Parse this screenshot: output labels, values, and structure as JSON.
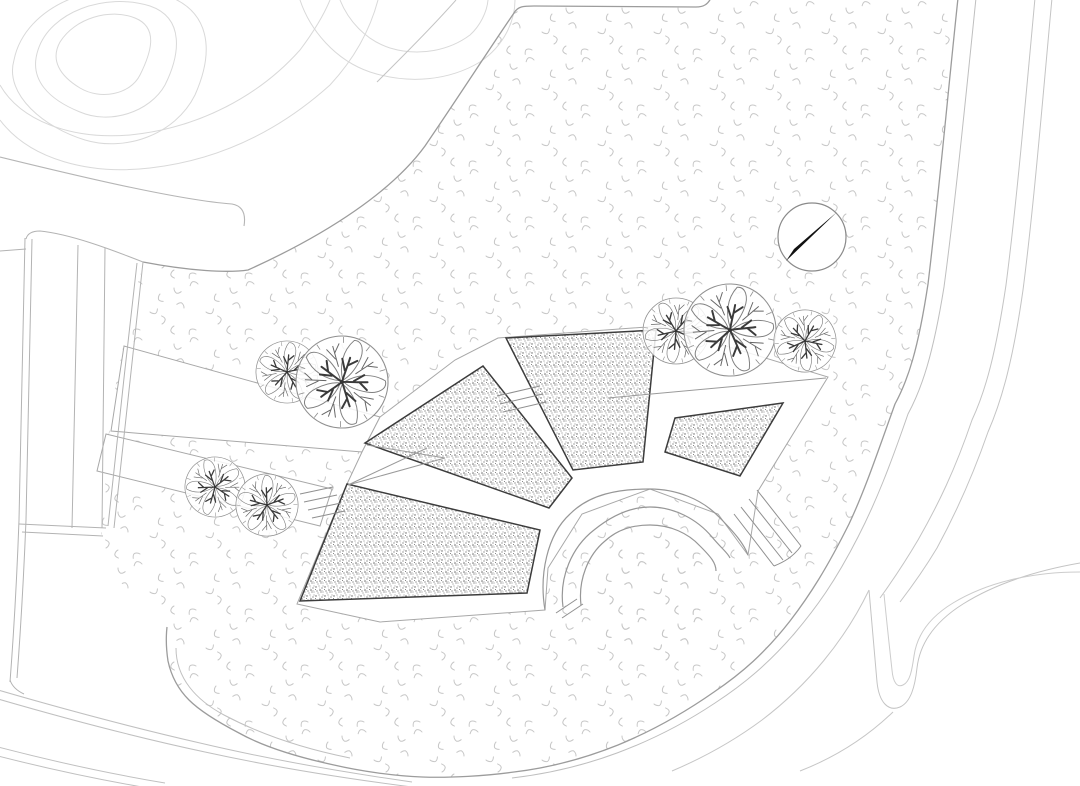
{
  "site": {
    "width": 1080,
    "height": 786,
    "kind": "landscape-site-plan"
  },
  "palette": {
    "background": "#ffffff",
    "grass_mark": "#c7c7c7",
    "stipple_dot": "#606060",
    "bed_border": "#3c3c3c",
    "edge_line": "#a8a8a8",
    "boundary_line": "#9c9c9c",
    "road_line": "#c0c0c0",
    "contour_line": "#d9d9d9",
    "arc_line": "#979797",
    "tree_branch": "#3a3a3a",
    "tree_outline": "#909090",
    "needle": "#111111"
  },
  "north_arrow": {
    "cx": 812,
    "cy": 237,
    "r": 34,
    "needle_points": "837,212 786,261 794,249"
  },
  "trees": [
    {
      "cx": 287,
      "cy": 372,
      "r": 31,
      "rot": 10
    },
    {
      "cx": 342,
      "cy": 382,
      "r": 46,
      "rot": 95
    },
    {
      "cx": 215,
      "cy": 487,
      "r": 30,
      "rot": 200
    },
    {
      "cx": 267,
      "cy": 505,
      "r": 31,
      "rot": 290
    },
    {
      "cx": 676,
      "cy": 331,
      "r": 33,
      "rot": 45
    },
    {
      "cx": 730,
      "cy": 330,
      "r": 46,
      "rot": 160
    },
    {
      "cx": 805,
      "cy": 341,
      "r": 31,
      "rot": 250
    }
  ],
  "tree_parts": {
    "petal": "M0,-2 C-9,-14 -12,-30 -5,-44 C3,-47 9,-38 8,-26 C7,-15 4,-7 0,-2 Z",
    "branch": "M0,0 C-1,-8 -1,-16 -2,-26 M-2,-12 L-9,-22 M-1,-18 L6,-26",
    "twig": "M0,-16 L-1,-38 M-1,-24 L-8,-36 M-1,-30 L6,-39",
    "tick": "M0,-40 L0,-46"
  },
  "ops": [
    {
      "t": "path",
      "name": "grass-lawn-area",
      "d": "M143,262 C190,271 228,273 248,270 C330,233 393,190 425,146 C457,99 492,45 514,13 C518,6 524,6 534,6 L696,7 C704,7 708,4 711,-2 L958,-2 C948,92 938,202 928,284 C918,350 908,380 895,404 C877,454 865,490 849,524 C827,568 810,595 790,621 C765,653 742,673 714,692 C684,713 652,731 618,745 C583,759 548,768 514,772 C486,776 450,778 422,777 C394,776 360,771 334,765 C297,757 264,747 239,733 C216,721 199,710 189,700 C177,688 171,675 168,661 C166,648 166,636 167,627 C145,612 118,585 105,555 C99,536 100,498 103,468 C106,444 108,436 110,428 C116,370 129,320 143,262 Z",
      "f": "url(#grass)",
      "s": "none",
      "w": 0
    },
    {
      "t": "circle",
      "name": "amphitheater-lawn-bowl",
      "cx": 650,
      "cy": 597,
      "r": 66,
      "f": "url(#grass)",
      "s": "none",
      "w": 0
    },
    {
      "t": "path",
      "name": "contour-line",
      "d": "M60,42 C75,18 110,8 135,18 C160,28 150,55 140,75 C130,95 100,100 80,88 C60,76 50,60 60,42 Z",
      "f": "none",
      "s": "#d9d9d9",
      "w": 1
    },
    {
      "t": "path",
      "name": "contour-line",
      "d": "M38,50 C50,12 105,-8 150,6 C185,18 180,55 165,85 C150,112 110,125 80,112 C50,100 28,80 38,50 Z",
      "f": "none",
      "s": "#d9d9d9",
      "w": 1
    },
    {
      "t": "path",
      "name": "contour-line",
      "d": "M14,60 C25,5 100,-25 165,-5 C210,10 215,50 195,95 C175,135 125,152 85,140 C45,128 4,95 14,60 Z",
      "f": "none",
      "s": "#d9d9d9",
      "w": 1
    },
    {
      "t": "path",
      "name": "contour-line",
      "d": "M0,85 C20,120 70,140 130,135 C200,128 260,95 300,50 C315,30 325,12 330,0",
      "f": "none",
      "s": "#d9d9d9",
      "w": 1
    },
    {
      "t": "path",
      "name": "contour-line",
      "d": "M0,120 C30,160 90,175 150,168 C220,160 280,130 330,85 C355,58 370,30 378,0",
      "f": "none",
      "s": "#d9d9d9",
      "w": 1
    },
    {
      "t": "path",
      "name": "contour-line",
      "d": "M300,0 C310,30 335,60 370,72 C410,85 450,80 480,62 C505,45 515,20 515,0",
      "f": "none",
      "s": "#d9d9d9",
      "w": 1
    },
    {
      "t": "path",
      "name": "contour-line",
      "d": "M340,0 C348,20 365,40 390,48 C420,57 450,50 470,35 C480,26 487,12 488,0",
      "f": "none",
      "s": "#d9d9d9",
      "w": 1
    },
    {
      "t": "path",
      "name": "upper-path-edge",
      "d": "M0,157 C90,179 180,200 232,204 C243,206 246,214 244,226",
      "f": "none",
      "s": "#b5b5b5",
      "w": 1.1
    },
    {
      "t": "path",
      "name": "diagonal-path-edge",
      "d": "M377,82 C404,55 432,27 456,0",
      "f": "none",
      "s": "#c4c4c4",
      "w": 1
    },
    {
      "t": "path",
      "name": "lawn-top-boundary",
      "d": "M143,262 C190,271 228,273 248,270 C330,233 393,190 425,146 C457,99 492,45 514,13 C518,6 524,6 534,6 L696,7 C704,7 708,4 711,-2",
      "f": "none",
      "s": "#9c9c9c",
      "w": 1.3
    },
    {
      "t": "poly",
      "name": "walkway-upper",
      "pts": "124,346 380,417 362,452 111,431",
      "f": "#ffffff",
      "s": "#a8a8a8",
      "w": 1
    },
    {
      "t": "poly",
      "name": "walkway-lower",
      "pts": "106,434 332,489 320,526 97,471",
      "f": "#ffffff",
      "s": "#a8a8a8",
      "w": 1
    },
    {
      "t": "poly",
      "name": "fan-plaza",
      "pts": "380,417 455,360 498,338 660,326 828,377 758,491 748,555 718,514 650,489 582,514 548,568 545,610 380,622 297,604 347,484 362,452",
      "f": "#ffffff",
      "s": "#a8a8a8",
      "w": 1
    },
    {
      "t": "poly",
      "name": "planting-bed-1",
      "pts": "300,601 347,484 540,530 527,593",
      "f": "url(#stipple)",
      "s": "#3c3c3c",
      "w": 1.5
    },
    {
      "t": "poly",
      "name": "planting-bed-2",
      "pts": "365,443 483,366 572,478 549,508",
      "f": "url(#stipple)",
      "s": "#3c3c3c",
      "w": 1.5
    },
    {
      "t": "poly",
      "name": "planting-bed-3",
      "pts": "506,338 656,330 643,462 573,470",
      "f": "url(#stipple)",
      "s": "#3c3c3c",
      "w": 1.5
    },
    {
      "t": "poly",
      "name": "planting-bed-4",
      "pts": "675,418 783,403 740,476 665,452",
      "f": "url(#stipple)",
      "s": "#3c3c3c",
      "w": 1.5
    },
    {
      "t": "path",
      "name": "amphitheater-arc-inner",
      "d": "M581,605 C578,580 588,555 605,541 C618,529 633,525 650,525 C670,525 688,533 700,546 C711,557 716,563 716,571",
      "f": "none",
      "s": "#979797",
      "w": 1.2
    },
    {
      "t": "path",
      "name": "amphitheater-arc-middle",
      "d": "M563,607 C559,577 572,547 594,530 C610,517 629,507 650,507 C674,507 697,519 712,537 C722,549 728,553 730,558",
      "f": "none",
      "s": "#979797",
      "w": 1.2
    },
    {
      "t": "path",
      "name": "amphitheater-arc-outer",
      "d": "M545,610 C539,575 547,535 570,514 C590,494 618,489 650,489 C676,489 702,499 719,517 C735,533 744,544 748,555",
      "f": "none",
      "s": "#979797",
      "w": 1.2
    },
    {
      "t": "lines",
      "name": "amphitheater-stairs",
      "s": "#8f8f8f",
      "w": 1,
      "segs": [
        [
          757,
          490,
          801,
          546
        ],
        [
          749,
          499,
          792,
          553
        ],
        [
          741,
          507,
          783,
          560
        ],
        [
          734,
          514,
          774,
          566
        ]
      ]
    },
    {
      "t": "path",
      "name": "stair-edge",
      "d": "M801,546 C793,557 784,562 774,566",
      "f": "none",
      "s": "#8f8f8f",
      "w": 1
    },
    {
      "t": "lines",
      "name": "steps-between-beds",
      "s": "#8f8f8f",
      "w": 1,
      "segs": [
        [
          497,
          396,
          540,
          386
        ],
        [
          500,
          404,
          543,
          394
        ],
        [
          503,
          412,
          546,
          402
        ]
      ]
    },
    {
      "t": "lines",
      "name": "steps-walkway",
      "s": "#8f8f8f",
      "w": 1,
      "segs": [
        [
          300,
          494,
          333,
          487
        ],
        [
          304,
          502,
          337,
          495
        ],
        [
          308,
          510,
          341,
          503
        ],
        [
          312,
          518,
          345,
          511
        ]
      ]
    },
    {
      "t": "lines",
      "name": "ramp-zigzag",
      "s": "#9a9a9a",
      "w": 1,
      "segs": [
        [
          348,
          485,
          445,
          458
        ],
        [
          367,
          445,
          445,
          458
        ],
        [
          348,
          485,
          427,
          448
        ]
      ]
    },
    {
      "t": "lines",
      "name": "path-end-cap",
      "s": "#8f8f8f",
      "w": 1,
      "segs": [
        [
          556,
          613,
          577,
          599
        ],
        [
          562,
          618,
          583,
          604
        ]
      ]
    },
    {
      "t": "path",
      "name": "plaza-top-edge",
      "d": "M608,398 L826,378",
      "f": "none",
      "s": "#9a9a9a",
      "w": 1
    },
    {
      "t": "path",
      "name": "lawn-right-boundary",
      "d": "M958,-2 C948,92 938,202 928,284 C918,350 908,380 895,404 C877,454 865,490 849,524 C827,568 810,595 790,621 C765,653 742,673 714,692 C684,713 652,731 618,745 C583,759 548,768 514,772 C486,776 450,778 422,777 C394,776 360,771 334,765 C297,757 264,747 239,733 C216,721 199,710 189,700 C177,688 171,675 168,661 C166,648 166,636 167,627",
      "f": "none",
      "s": "#9c9c9c",
      "w": 1.3
    },
    {
      "t": "path",
      "name": "lawn-corner-inner-line",
      "d": "M176,648 C176,678 196,700 224,715 C258,733 300,748 350,758",
      "f": "none",
      "s": "#c0c0c0",
      "w": 1
    },
    {
      "t": "path",
      "name": "ring-road-line",
      "d": "M976,-2 C966,95 955,205 944,287 C933,355 922,388 908,414 C890,466 876,502 858,537 C835,582 816,608 794,634 C768,664 744,684 715,703 C685,723 652,740 617,753 C582,766 546,774 512,778",
      "f": "none",
      "s": "#bfbfbf",
      "w": 1
    },
    {
      "t": "path",
      "name": "ring-road-line",
      "d": "M1035,-2 C1026,95 1017,200 1006,285 C996,352 986,390 972,420 C955,470 938,505 918,540 C905,562 893,580 880,598",
      "f": "none",
      "s": "#c4c4c4",
      "w": 1
    },
    {
      "t": "path",
      "name": "ring-road-line",
      "d": "M1052,-2 C1043,95 1034,205 1023,290 C1013,360 1002,400 988,432 C972,478 956,513 937,548 C925,568 913,585 900,602",
      "f": "none",
      "s": "#c4c4c4",
      "w": 1
    },
    {
      "t": "path",
      "name": "hairpin-path",
      "d": "M869,590 C872,625 875,660 877,682 C879,702 888,712 900,707 C911,702 915,686 917,668 C920,642 936,621 963,604 C998,582 1040,570 1080,563",
      "f": "none",
      "s": "#c4c4c4",
      "w": 1
    },
    {
      "t": "path",
      "name": "hairpin-path",
      "d": "M884,594 C887,625 890,652 892,670 C893,682 897,688 903,685 C910,682 912,670 914,656 C917,634 930,617 953,603 C986,583 1030,572 1080,572",
      "f": "none",
      "s": "#cccccc",
      "w": 1
    },
    {
      "t": "path",
      "name": "south-path-line",
      "d": "M869,590 C845,640 808,685 762,720 C735,740 705,757 672,771",
      "f": "none",
      "s": "#c6c6c6",
      "w": 1
    },
    {
      "t": "path",
      "name": "south-path-line",
      "d": "M893,712 C867,737 836,757 800,771",
      "f": "none",
      "s": "#c6c6c6",
      "w": 1
    },
    {
      "t": "path",
      "name": "southwest-road-line",
      "d": "M-2,690 C60,708 130,727 200,743 C272,760 342,772 412,782",
      "f": "none",
      "s": "#c0c0c0",
      "w": 1
    },
    {
      "t": "path",
      "name": "southwest-road-line",
      "d": "M-2,699 C60,717 130,736 205,752 C278,768 348,779 420,788",
      "f": "none",
      "s": "#c0c0c0",
      "w": 1
    },
    {
      "t": "path",
      "name": "southwest-road-line",
      "d": "M-2,747 C48,760 105,773 165,783",
      "f": "none",
      "s": "#c0c0c0",
      "w": 1
    },
    {
      "t": "path",
      "name": "southwest-road-line",
      "d": "M-2,756 C45,768 95,779 148,788",
      "f": "none",
      "s": "#c0c0c0",
      "w": 1
    },
    {
      "t": "path",
      "name": "west-road-line",
      "d": "M25,238 C23,330 21,430 19,520 C17,575 14,630 10,682",
      "f": "none",
      "s": "#b3b3b3",
      "w": 1
    },
    {
      "t": "path",
      "name": "west-road-line",
      "d": "M32,239 C30,330 28,430 26,520 C24,570 21,625 17,678",
      "f": "none",
      "s": "#b3b3b3",
      "w": 1
    },
    {
      "t": "path",
      "name": "west-road-line",
      "d": "M78,245 C76,340 74,440 72,528",
      "f": "none",
      "s": "#b3b3b3",
      "w": 1
    },
    {
      "t": "path",
      "name": "west-road-line",
      "d": "M105,248 C104,340 103,440 102,528",
      "f": "none",
      "s": "#b3b3b3",
      "w": 1
    },
    {
      "t": "path",
      "name": "west-road-line",
      "d": "M137,263 C127,350 117,440 108,526",
      "f": "none",
      "s": "#b3b3b3",
      "w": 1
    },
    {
      "t": "path",
      "name": "west-road-line",
      "d": "M143,262 C133,352 123,442 114,528",
      "f": "none",
      "s": "#b3b3b3",
      "w": 1
    },
    {
      "t": "path",
      "name": "west-road-top-corner",
      "d": "M26,239 Q28,231 40,231 C70,234 110,249 143,262",
      "f": "none",
      "s": "#b3b3b3",
      "w": 1
    },
    {
      "t": "path",
      "name": "west-road-stub",
      "d": "M0,251 L26,249",
      "f": "none",
      "s": "#b3b3b3",
      "w": 1
    },
    {
      "t": "lines",
      "name": "west-road-end",
      "s": "#b3b3b3",
      "w": 1,
      "segs": [
        [
          19,
          524,
          106,
          528
        ],
        [
          22,
          532,
          103,
          536
        ]
      ]
    },
    {
      "t": "path",
      "name": "west-road-join",
      "d": "M10,680 Q13,689 24,694",
      "f": "none",
      "s": "#b3b3b3",
      "w": 1
    }
  ]
}
